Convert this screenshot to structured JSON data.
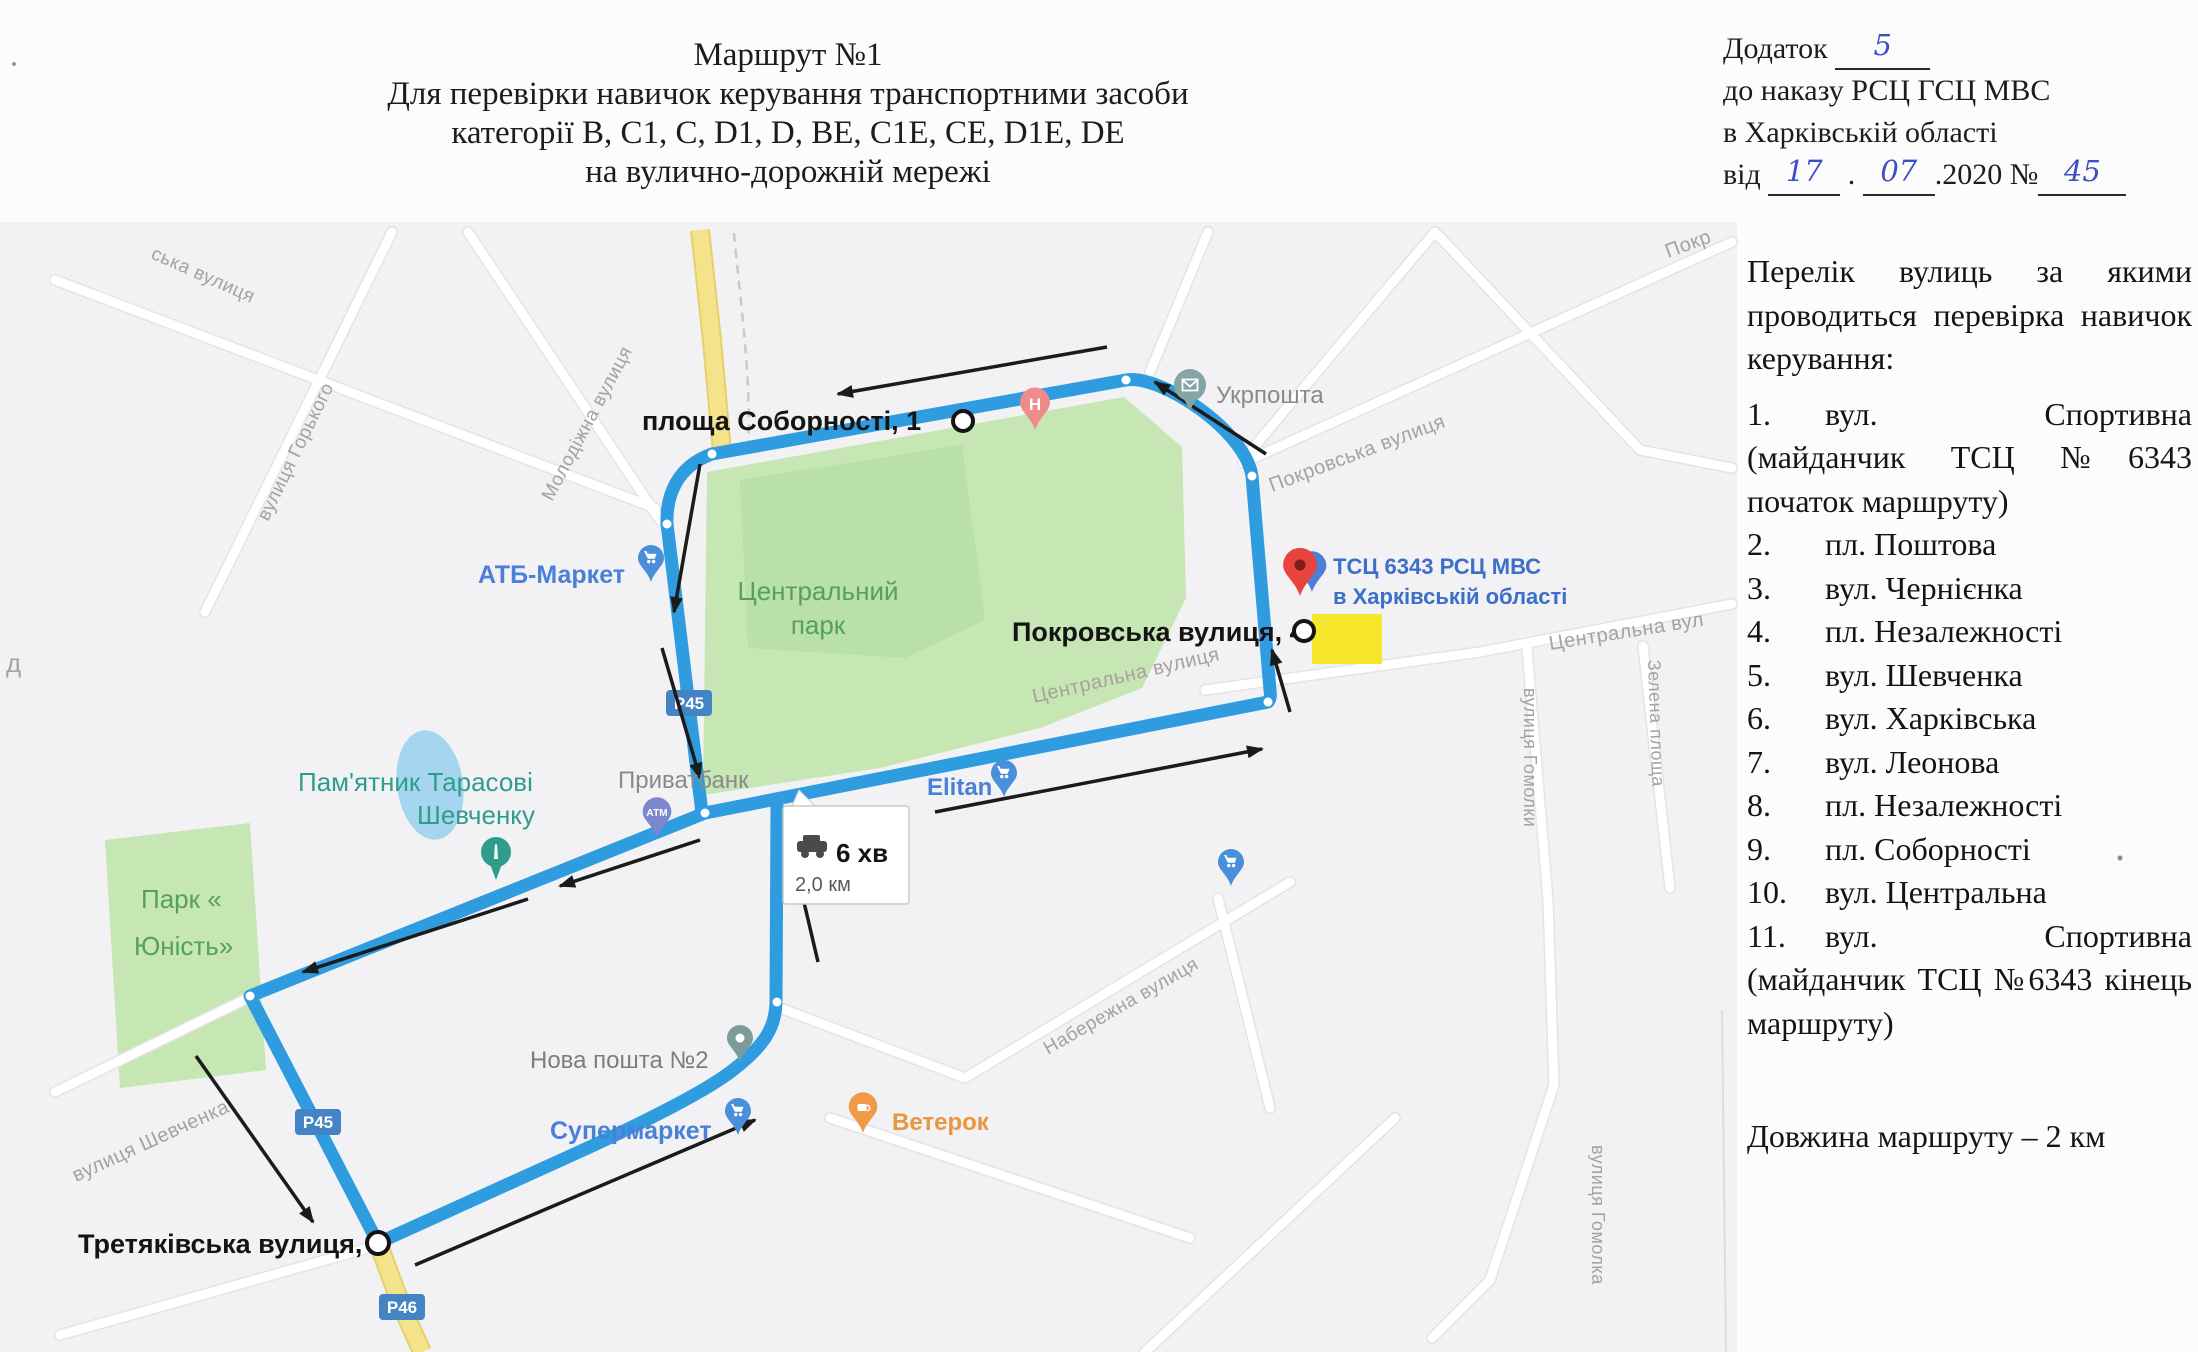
{
  "header": {
    "title_lines": [
      "Маршрут №1",
      "Для перевірки навичок керування транспортними засоби",
      "категорії B, C1, C, D1, D, BE, C1E, CE, D1E, DE",
      "на вулично-дорожній мережі"
    ]
  },
  "annex": {
    "line1_label": "Додаток",
    "line1_value": "5",
    "line2": "до наказу РСЦ ГСЦ МВС",
    "line3": "в Харківській області",
    "line4_prefix": "від",
    "day": "17",
    "month": "07",
    "year_suffix": ".2020",
    "number_sign": "№",
    "order_number": "45"
  },
  "streets_panel": {
    "intro": "Перелік вулиць за якими проводиться перевірка навичок керування:",
    "items": [
      {
        "num": "1.",
        "text": "вул. Спортивна (майданчик ТСЦ №6343 початок маршруту)"
      },
      {
        "num": "2.",
        "text": "пл. Поштова"
      },
      {
        "num": "3.",
        "text": "вул. Чернієнка"
      },
      {
        "num": "4.",
        "text": "пл. Незалежності"
      },
      {
        "num": "5.",
        "text": "вул. Шевченка"
      },
      {
        "num": "6.",
        "text": "вул. Харківська"
      },
      {
        "num": "7.",
        "text": "вул. Леонова"
      },
      {
        "num": "8.",
        "text": "пл. Незалежності"
      },
      {
        "num": "9.",
        "text": "пл. Соборності"
      },
      {
        "num": "10.",
        "text": "вул. Центральна"
      },
      {
        "num": "11.",
        "text": "вул. Спортивна (майданчик ТСЦ №6343 кінець маршруту)"
      }
    ],
    "route_length": "Довжина маршруту – 2 км"
  },
  "map": {
    "info_box": {
      "time": "6 хв",
      "distance": "2,0 км"
    },
    "shields": {
      "p45": "Р45",
      "p46": "Р46"
    },
    "labels": {
      "sobornosti": "площа Соборності, 1",
      "ukrposhta": "Укрпошта",
      "pokrovska_street": "Покровська вулиця",
      "pokrovska_partial": "Покр",
      "tsc_line1": "ТСЦ 6343 РСЦ МВС",
      "tsc_line2": "в Харківській області",
      "pokrovska4": "Покровська вулиця, 4",
      "centralna_street": "Центральна вулиця",
      "centralna_street2": "Центральна вул",
      "homolky": "вулиця Гомолки",
      "homolka": "вулиця Гомолка",
      "zelena": "Зелена площа",
      "naberezhna": "Набережна вулиця",
      "atb": "АТБ-Маркет",
      "central_park_line1": "Центральний",
      "central_park_line2": "парк",
      "pamyatnik_line1": "Пам'ятник Тарасові",
      "pamyatnik_line2": "Шевченку",
      "privatbank": "Приватбанк",
      "atm": "АТМ",
      "hospital": "Н",
      "elitan": "Elitan",
      "nova_poshta": "Нова пошта №2",
      "park_yunist_line1": "Парк «",
      "park_yunist_line2": "Юність»",
      "shevchenka_street": "вулиця Шевченка",
      "supermarket": "Супермаркет",
      "veterok": "Ветерок",
      "tretyakivska": "Третяківська вулиця, 1",
      "molodizhna": "Молодіжна вулиця",
      "horkoho": "вулиця Горького",
      "ska_partial": "ська вулиця",
      "d_partial": "д"
    },
    "colors": {
      "route": "#2f9ce0",
      "park_fill": "#c6e6b3",
      "park_label": "#55a05e",
      "road_yellow": "#f5e38c",
      "poi_blue": "#4a80d8",
      "street_label": "#a6a29c",
      "grey_poi_label": "#8a8a8a",
      "shield_blue": "#4584c4",
      "handwriting_blue": "#3e4fc5",
      "tsc_label_blue": "#3b6fc9",
      "veterok_orange": "#e8963f",
      "arrow_black": "#1b1b1b"
    }
  }
}
